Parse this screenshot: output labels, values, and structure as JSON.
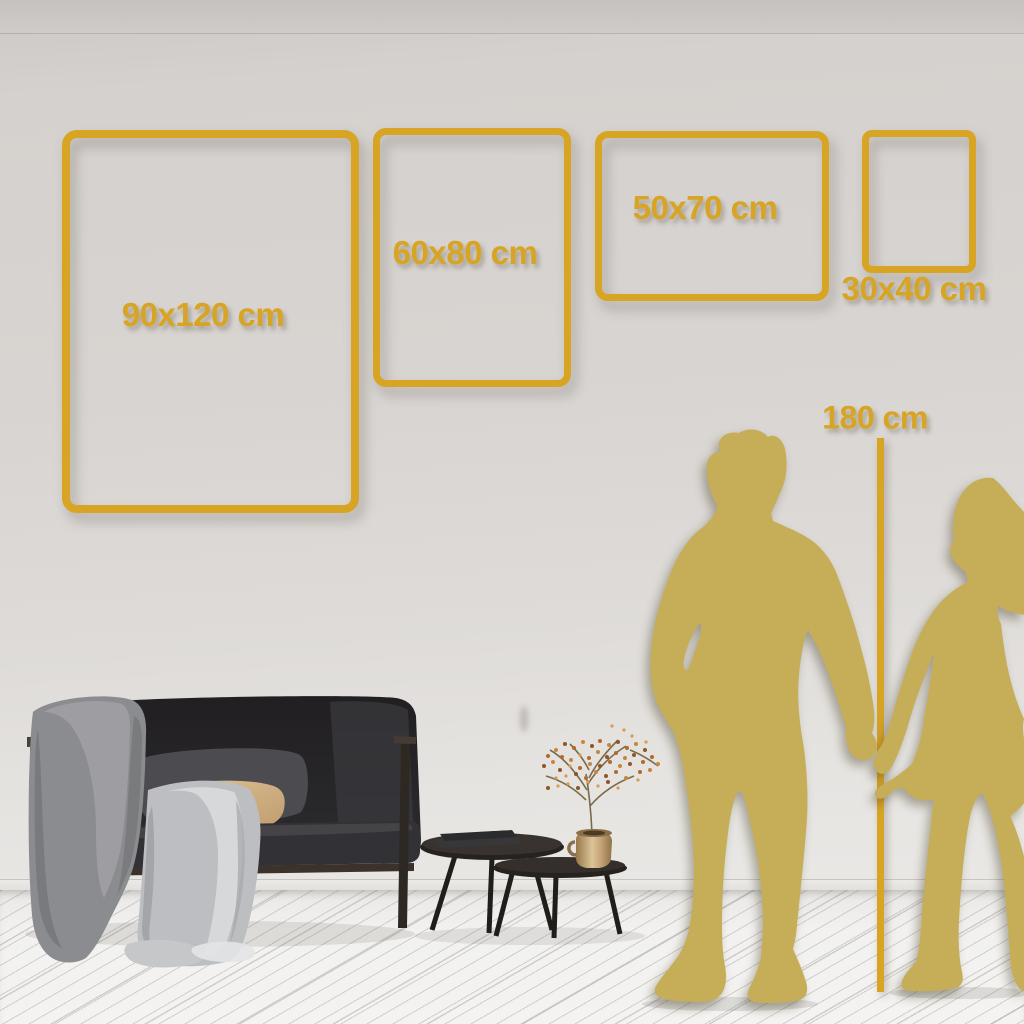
{
  "colors": {
    "gold": "#D8A424",
    "silhouette_gold": "#C6AE59",
    "wall_light": "#D8D4D1",
    "floor_light": "#F1F0EE"
  },
  "size_guide": {
    "frames": [
      {
        "label": "90x120 cm"
      },
      {
        "label": "60x80 cm"
      },
      {
        "label": "50x70 cm"
      },
      {
        "label": "30x40 cm"
      }
    ],
    "height_reference": {
      "label": "180 cm"
    }
  }
}
